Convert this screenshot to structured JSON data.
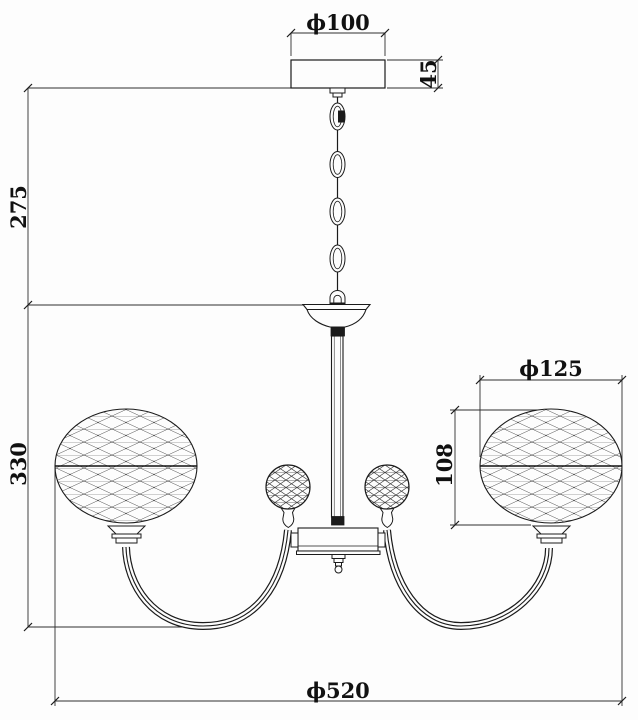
{
  "drawing": {
    "kind": "chandelier dimension drawing",
    "dimensions": {
      "canopy_diameter": "ϕ100",
      "canopy_height": "45",
      "suspension_height": "275",
      "body_height": "330",
      "shade_diameter": "ϕ125",
      "shade_height": "108",
      "overall_diameter": "ϕ520"
    },
    "colors": {
      "line": "#1b1b1b",
      "dimension_line": "#2e2e2e",
      "background": "#fdfdfd",
      "text": "#111111"
    }
  }
}
